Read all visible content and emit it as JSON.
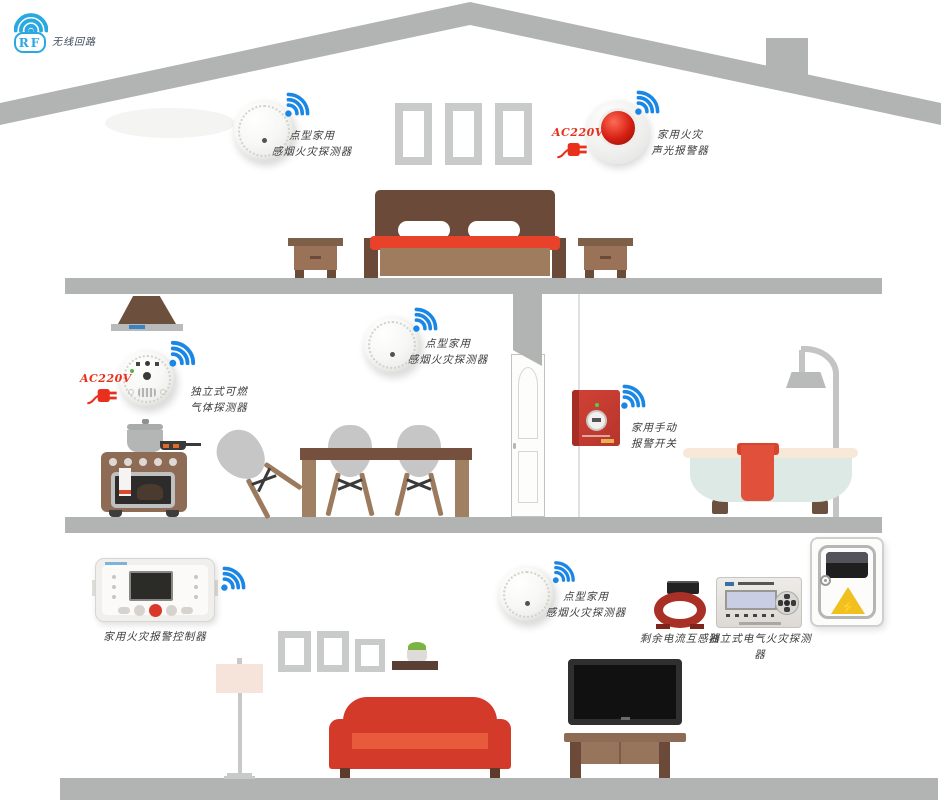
{
  "logo": {
    "abbr": "RF",
    "label": "无线回路"
  },
  "power_label": "AC220V",
  "devices": {
    "smoke_attic": {
      "line1": "点型家用",
      "line2": "感烟火灾探测器"
    },
    "sounder": {
      "line1": "家用火灾",
      "line2": "声光报警器"
    },
    "gas": {
      "line1": "独立式可燃",
      "line2": "气体探测器"
    },
    "smoke_mid": {
      "line1": "点型家用",
      "line2": "感烟火灾探测器"
    },
    "manual_switch": {
      "line1": "家用手动",
      "line2": "报警开关"
    },
    "controller": {
      "label": "家用火灾报警控制器"
    },
    "smoke_ground": {
      "line1": "点型家用",
      "line2": "感烟火灾探测器"
    },
    "ct": {
      "label": "剩余电流互感器"
    },
    "electric": {
      "label": "独立式电气火灾探测器"
    }
  },
  "icons": {
    "wifi": "wifi-signal",
    "plug": "power-plug",
    "hazard_glyph": "⚡"
  },
  "colors": {
    "accent_blue": "#1b87e5",
    "logo_blue": "#2aa9e0",
    "alert_red": "#e8301d",
    "structure_gray": "#b2b4b3",
    "alarm_red": "#c23b31",
    "sofa_red": "#d33a2a"
  }
}
